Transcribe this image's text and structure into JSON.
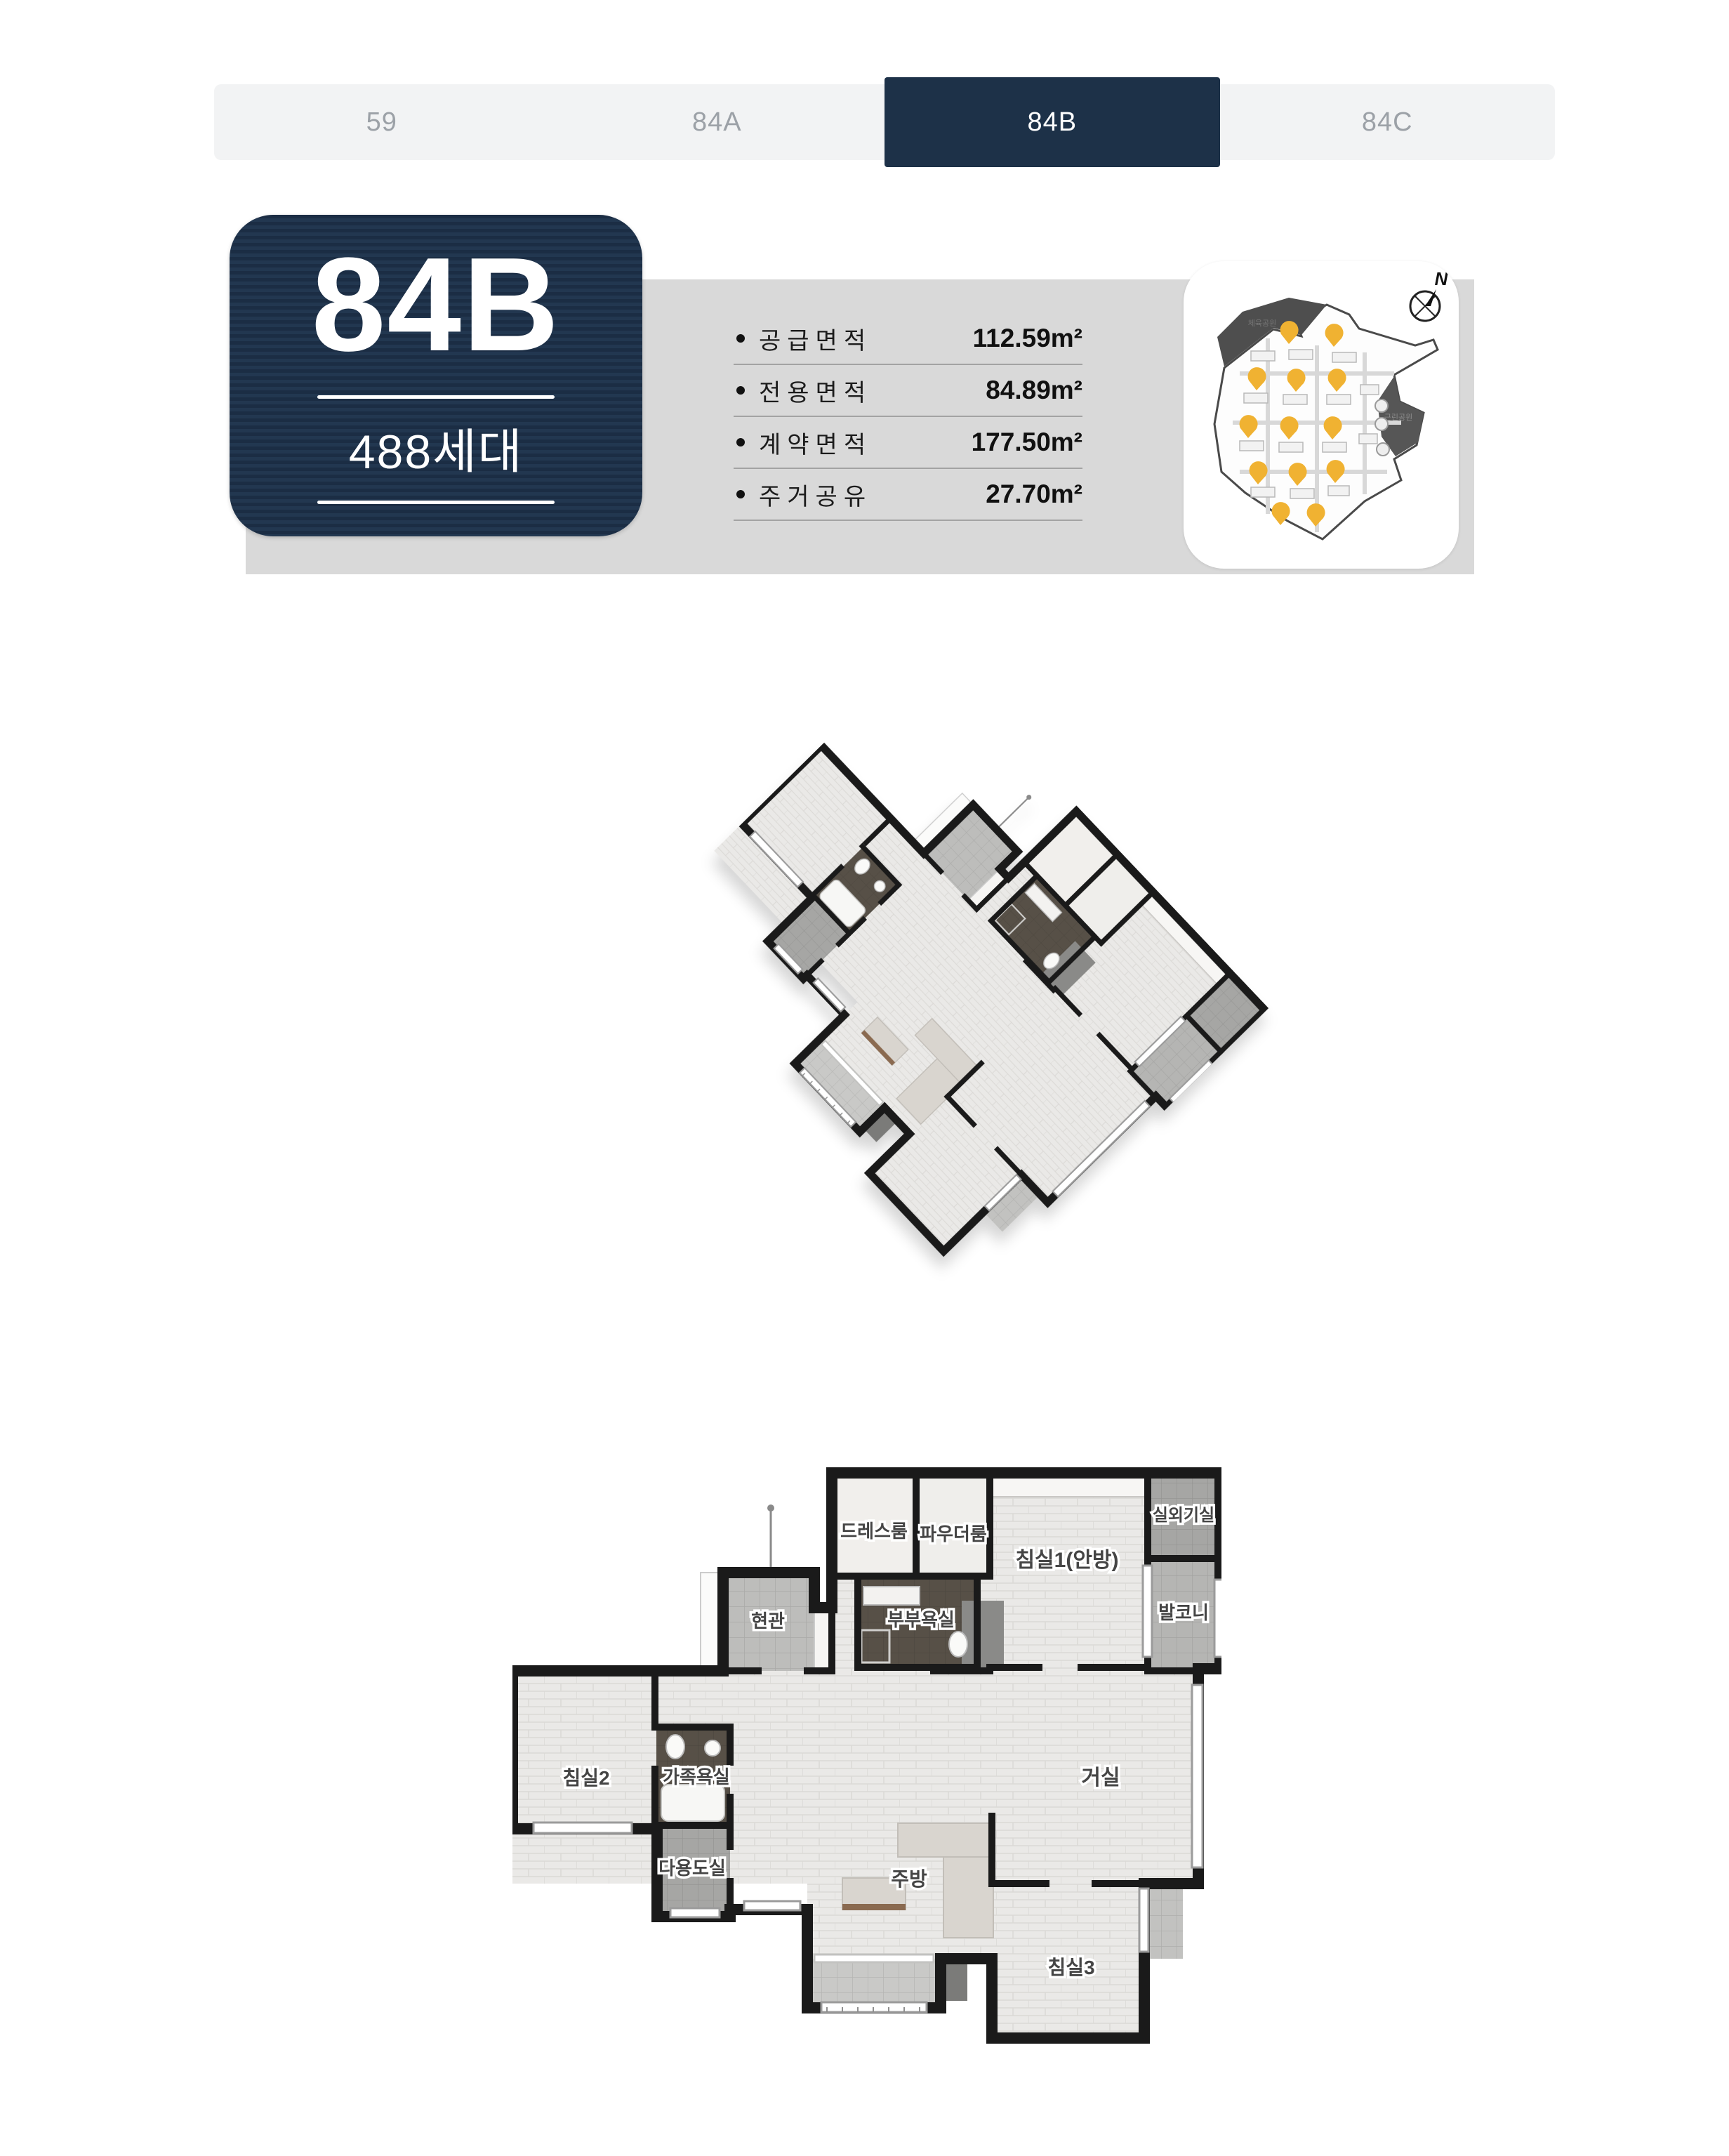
{
  "tabs": {
    "items": [
      {
        "label": "59",
        "active": false
      },
      {
        "label": "84A",
        "active": false
      },
      {
        "label": "84B",
        "active": true
      },
      {
        "label": "84C",
        "active": false
      }
    ]
  },
  "unit": {
    "name": "84B",
    "households": "488세대"
  },
  "specs": {
    "rows": [
      {
        "label": "공급면적",
        "value": "112.59m²"
      },
      {
        "label": "전용면적",
        "value": "84.89m²"
      },
      {
        "label": "계약면적",
        "value": "177.50m²"
      },
      {
        "label": "주거공유",
        "value": "27.70m²"
      }
    ]
  },
  "site_map": {
    "compass": "N",
    "parks": [
      {
        "label": "체육공원"
      },
      {
        "label": "근린공원"
      }
    ]
  },
  "plan": {
    "rooms": [
      {
        "label": "드레스룸"
      },
      {
        "label": "파우더룸"
      },
      {
        "label": "침실1(안방)"
      },
      {
        "label": "실외기실"
      },
      {
        "label": "발코니"
      },
      {
        "label": "부부욕실"
      },
      {
        "label": "현관"
      },
      {
        "label": "침실2"
      },
      {
        "label": "가족욕실"
      },
      {
        "label": "다용도실"
      },
      {
        "label": "주방"
      },
      {
        "label": "거실"
      },
      {
        "label": "침실3"
      }
    ]
  },
  "colors": {
    "navy": "#1d3148",
    "band": "#d9d9d9",
    "marker_yellow": "#f0b232"
  }
}
